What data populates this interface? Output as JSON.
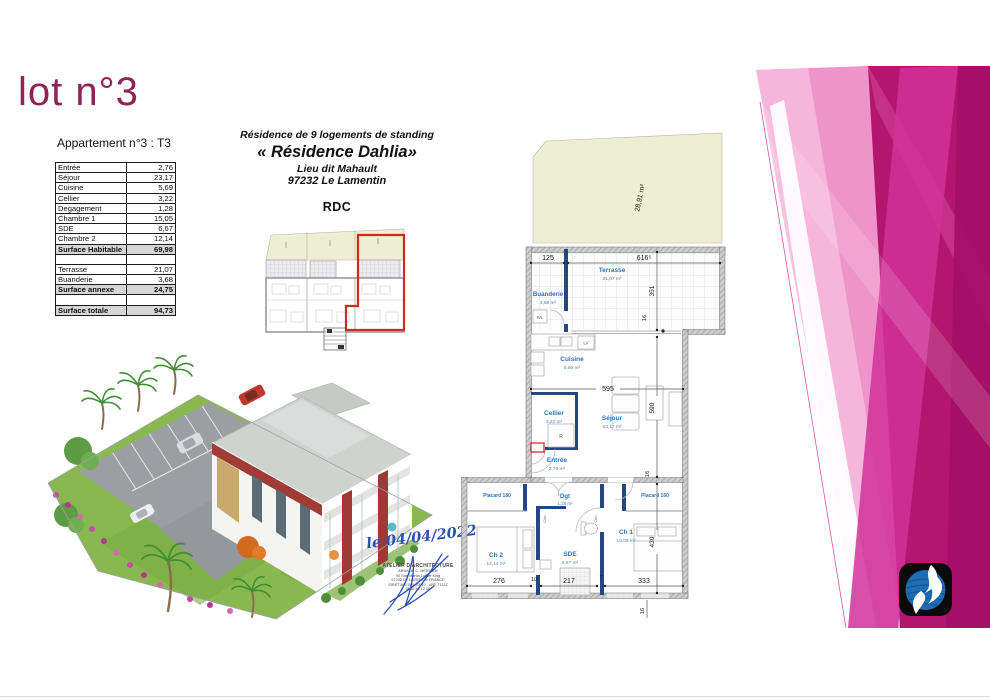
{
  "title": "lot n°3",
  "apartment": {
    "heading": "Appartement n°3 : T3",
    "table": {
      "rows": [
        {
          "label": "Entrée",
          "value": "2,76"
        },
        {
          "label": "Séjour",
          "value": "23,17"
        },
        {
          "label": "Cuisine",
          "value": "5,69"
        },
        {
          "label": "Cellier",
          "value": "3,22"
        },
        {
          "label": "Degagement",
          "value": "1,28"
        },
        {
          "label": "Chambre 1",
          "value": "15,05"
        },
        {
          "label": "SDE",
          "value": "6,67"
        },
        {
          "label": "Chambre 2",
          "value": "12,14"
        },
        {
          "label": "Surface Habitable",
          "value": "69,98"
        },
        {
          "label": "",
          "value": ""
        },
        {
          "label": "Terrasse",
          "value": "21,07"
        },
        {
          "label": "Buanderie",
          "value": "3,68"
        },
        {
          "label": "Surface annexe",
          "value": "24,75"
        },
        {
          "label": "",
          "value": ""
        },
        {
          "label": "Surface totale",
          "value": "94,73"
        }
      ]
    }
  },
  "project": {
    "line1": "Résidence de 9 logements de standing",
    "name": "« Résidence Dahlia»",
    "line3": "Lieu dit Mahault",
    "line4": "97232 Le Lamentin",
    "floor": "RDC"
  },
  "signature": {
    "date": "le 04/04/2022",
    "stamp_line1": "ATELIER D'ARCHITECTURE",
    "stamp_line2": "ARNAUD C. MERCIER",
    "stamp_line3": "90 Rue Martin Luther King",
    "stamp_line4": "97232 LE LAMENTIN FRANCE",
    "stamp_line5": "SIRET 880 000 00010 - APE 7111Z",
    "stamp_line6": "0696 40 12 06"
  },
  "floorplan": {
    "garden_area": "28,91 m²",
    "rooms": {
      "buanderie": {
        "name": "Buanderie",
        "area": "3,68 m²"
      },
      "terrasse": {
        "name": "Terrasse",
        "area": "21,07 m²"
      },
      "cuisine": {
        "name": "Cuisine",
        "area": "5,69 m²"
      },
      "cellier": {
        "name": "Cellier",
        "area": "3,22 m²"
      },
      "sejour": {
        "name": "Séjour",
        "area": "23,17 m²"
      },
      "entree": {
        "name": "Entrée",
        "area": "2,76 m²"
      },
      "dgt": {
        "name": "Dgt",
        "area": "1,28 m²"
      },
      "ch2": {
        "name": "Ch 2",
        "area": "12,14 m²"
      },
      "sde": {
        "name": "SDE",
        "area": "6,67 m²"
      },
      "ch1": {
        "name": "Ch 1",
        "area": "15,05 m²"
      }
    },
    "labels": {
      "placard_left": "Placard 180",
      "placard_right": "Placard 160",
      "wl": "WL",
      "lv": "LV",
      "r": "R",
      "clsn": "Clsn"
    },
    "dims": {
      "d125": "125",
      "d616": "616⁵",
      "d351": "351",
      "d16a": "16",
      "d595": "595",
      "d590": "590",
      "d16b": "16",
      "d430": "430",
      "d276": "276",
      "d217": "217",
      "d333": "333",
      "d10": "10",
      "d7": "7",
      "d16c": "16"
    }
  },
  "colors": {
    "title": "#8e2456",
    "pink_light": "#ef93cb",
    "pink_deep": "#b2166f",
    "room_label_blue": "#2e74b5",
    "wall_navy": "#24477f",
    "garden_beige": "#edeed3",
    "red_outline": "#cf2a20",
    "logo_blue": "#1e6cb3"
  }
}
